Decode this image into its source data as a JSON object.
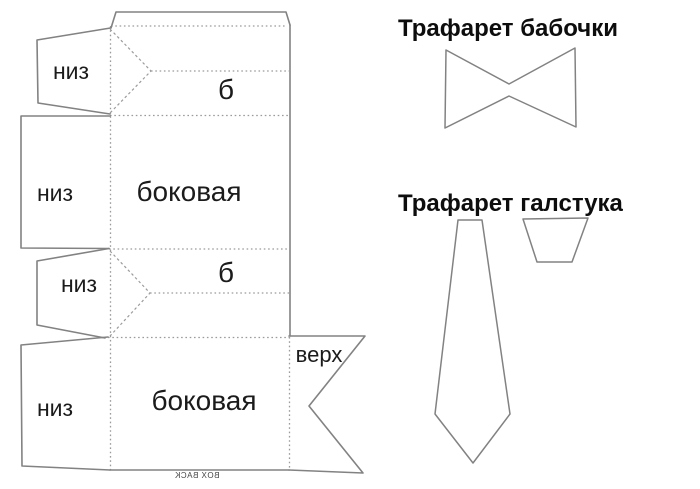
{
  "pattern": {
    "flap_label_1": "низ",
    "flap_label_2": "низ",
    "flap_label_3": "низ",
    "flap_label_4": "низ",
    "fold_label_1": "б",
    "fold_label_2": "б",
    "side_label_1": "боковая",
    "side_label_2": "боковая",
    "top_label": "верх",
    "watermark": "BOX BACK"
  },
  "stencils": {
    "bowtie_title": "Трафарет бабочки",
    "necktie_title": "Трафарет галстука"
  },
  "colors": {
    "background": "#ffffff",
    "outline": "#828282",
    "fold-line": "#9b9b9b",
    "label-text": "#1b1b1b",
    "title-text": "#0d0d0d"
  }
}
